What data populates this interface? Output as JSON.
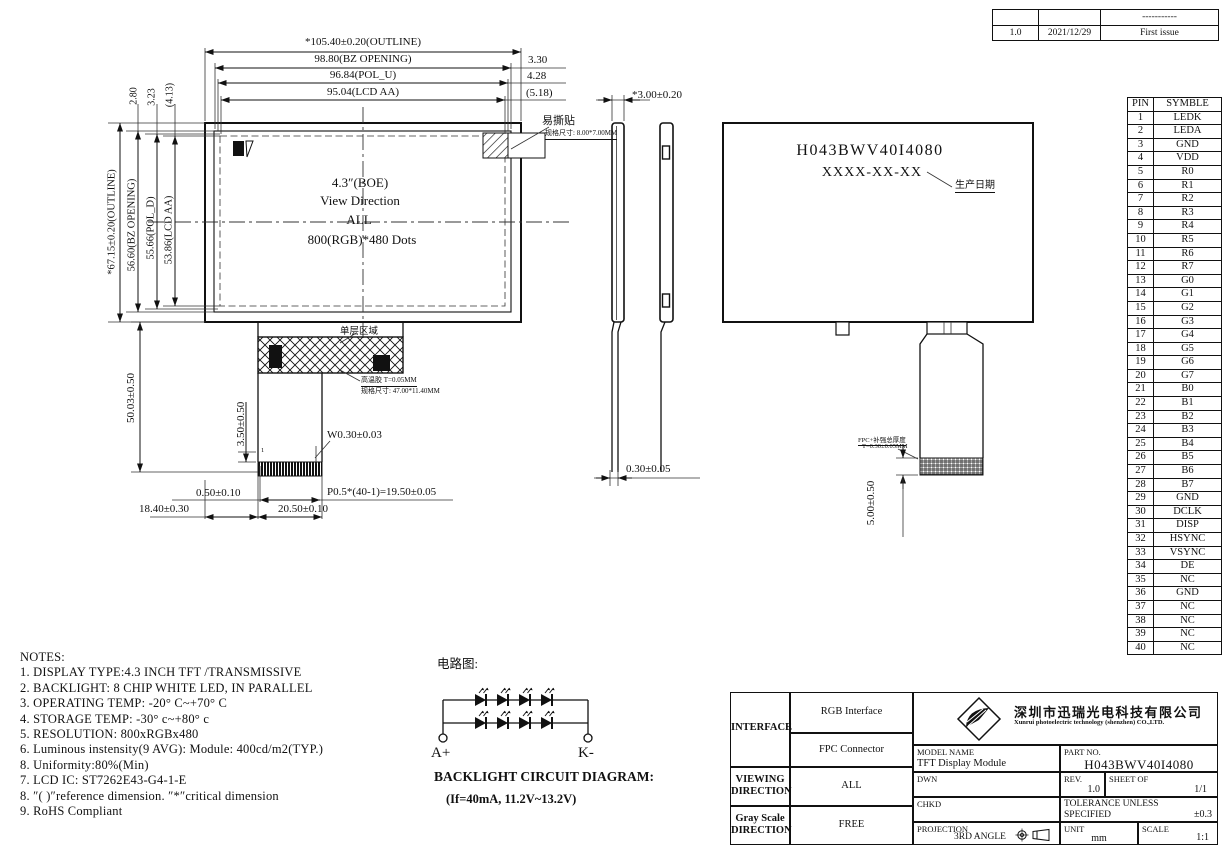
{
  "revision": {
    "rows": [
      [
        "",
        "",
        "-----------"
      ],
      [
        "1.0",
        "2021/12/29",
        "First issue"
      ]
    ]
  },
  "front": {
    "dims_top": [
      "*105.40±0.20(OUTLINE)",
      "98.80(BZ OPENING)",
      "96.84(POL_U)",
      "95.04(LCD AA)"
    ],
    "dims_top_right": [
      "3.30",
      "4.28",
      "(5.18)"
    ],
    "dims_left_gap": [
      "2.80",
      "3.23",
      "(4.13)"
    ],
    "dims_left": [
      "*67.15±0.20(OUTLINE)",
      "56.60(BZ OPENING)",
      "55.66(POL_D)",
      "53.86(LCD AA)"
    ],
    "center_lines": [
      "4.3″(BOE)",
      "View Direction",
      "ALL",
      "800(RGB)*480 Dots"
    ],
    "sticker_label": "易撕贴",
    "sticker_size": "规格尺寸: 8.00*7.00MM",
    "single_layer_label": "单层区域",
    "tape_label": "高温胶 T=0.05MM",
    "tape_size": "规格尺寸: 47.00*11.40MM",
    "pin1_marker": "1",
    "dim_stiffener": "3.50±0.50",
    "dim_finger_width": "W0.30±0.03",
    "dim_edge_margin": "0.50±0.10",
    "dim_pitch": "P0.5*(40-1)=19.50±0.05",
    "dim_tail_offset": "18.40±0.30",
    "dim_tail_width": "20.50±0.10",
    "dim_fpc_length": "50.03±0.50"
  },
  "side": {
    "dim_thickness": "*3.00±0.20",
    "dim_fpc_thickness": "0.30±0.05"
  },
  "back": {
    "part_no": "H043BWV40I4080",
    "date_placeholder": "XXXX-XX-XX",
    "date_label": "生产日期",
    "stiffener_note_1": "FPC+补强总厚度",
    "stiffener_note_2": "T=0.30±0.05MM",
    "dim_stiffener_offset": "5.00±0.50"
  },
  "pins": {
    "headers": [
      "PIN",
      "SYMBLE"
    ],
    "rows": [
      [
        "1",
        "LEDK"
      ],
      [
        "2",
        "LEDA"
      ],
      [
        "3",
        "GND"
      ],
      [
        "4",
        "VDD"
      ],
      [
        "5",
        "R0"
      ],
      [
        "6",
        "R1"
      ],
      [
        "7",
        "R2"
      ],
      [
        "8",
        "R3"
      ],
      [
        "9",
        "R4"
      ],
      [
        "10",
        "R5"
      ],
      [
        "11",
        "R6"
      ],
      [
        "12",
        "R7"
      ],
      [
        "13",
        "G0"
      ],
      [
        "14",
        "G1"
      ],
      [
        "15",
        "G2"
      ],
      [
        "16",
        "G3"
      ],
      [
        "17",
        "G4"
      ],
      [
        "18",
        "G5"
      ],
      [
        "19",
        "G6"
      ],
      [
        "20",
        "G7"
      ],
      [
        "21",
        "B0"
      ],
      [
        "22",
        "B1"
      ],
      [
        "23",
        "B2"
      ],
      [
        "24",
        "B3"
      ],
      [
        "25",
        "B4"
      ],
      [
        "26",
        "B5"
      ],
      [
        "27",
        "B6"
      ],
      [
        "28",
        "B7"
      ],
      [
        "29",
        "GND"
      ],
      [
        "30",
        "DCLK"
      ],
      [
        "31",
        "DISP"
      ],
      [
        "32",
        "HSYNC"
      ],
      [
        "33",
        "VSYNC"
      ],
      [
        "34",
        "DE"
      ],
      [
        "35",
        "NC"
      ],
      [
        "36",
        "GND"
      ],
      [
        "37",
        "NC"
      ],
      [
        "38",
        "NC"
      ],
      [
        "39",
        "NC"
      ],
      [
        "40",
        "NC"
      ]
    ]
  },
  "notes": {
    "title": "NOTES:",
    "items": [
      "1. DISPLAY TYPE:4.3 INCH TFT /TRANSMISSIVE",
      "2. BACKLIGHT: 8 CHIP WHITE LED, IN PARALLEL",
      "3. OPERATING TEMP: -20° C~+70° C",
      "4. STORAGE TEMP: -30° c~+80° c",
      "5. RESOLUTION: 800xRGBx480",
      "6. Luminous instensity(9 AVG):  Module: 400cd/m2(TYP.)",
      "8. Uniformity:80%(Min)",
      "7. LCD IC: ST7262E43-G4-1-E",
      "8. ″( )″reference dimension. ″*″critical dimension",
      "9. RoHS Compliant"
    ]
  },
  "circuit": {
    "title": "电路图:",
    "anode": "A+",
    "cathode": "K-",
    "caption": "BACKLIGHT CIRCUIT DIAGRAM:",
    "spec": "(If=40mA,  11.2V~13.2V)"
  },
  "titleblock": {
    "interface_label": "INTERFACE",
    "interface_1": "RGB Interface",
    "interface_2": "FPC Connector",
    "viewing_label_1": "VIEWING",
    "viewing_label_2": "DIRECTION",
    "viewing_value": "ALL",
    "gray_label_1": "Gray Scale",
    "gray_label_2": "DIRECTION",
    "gray_value": "FREE",
    "model_label": "MODEL NAME",
    "model_value": "TFT Display Module",
    "part_label": "PART NO.",
    "part_value": "H043BWV40I4080",
    "dwn_label": "DWN",
    "chkd_label": "CHKD",
    "rev_label": "REV.",
    "rev_value": "1.0",
    "sheet_label": "SHEET OF",
    "sheet_value": "1/1",
    "tol_line1": "TOLERANCE UNLESS",
    "tol_line2": "SPECIFIED",
    "tol_value": "±0.3",
    "proj_label": "PROJECTION",
    "proj_value": "3RD ANGLE",
    "unit_label": "UNIT",
    "unit_value": "mm",
    "scale_label": "SCALE",
    "scale_value": "1:1",
    "company_cn": "深圳市迅瑞光电科技有限公司",
    "company_en": "Xunrui photoelectric technology (shenzhen) CO.,LTD."
  }
}
